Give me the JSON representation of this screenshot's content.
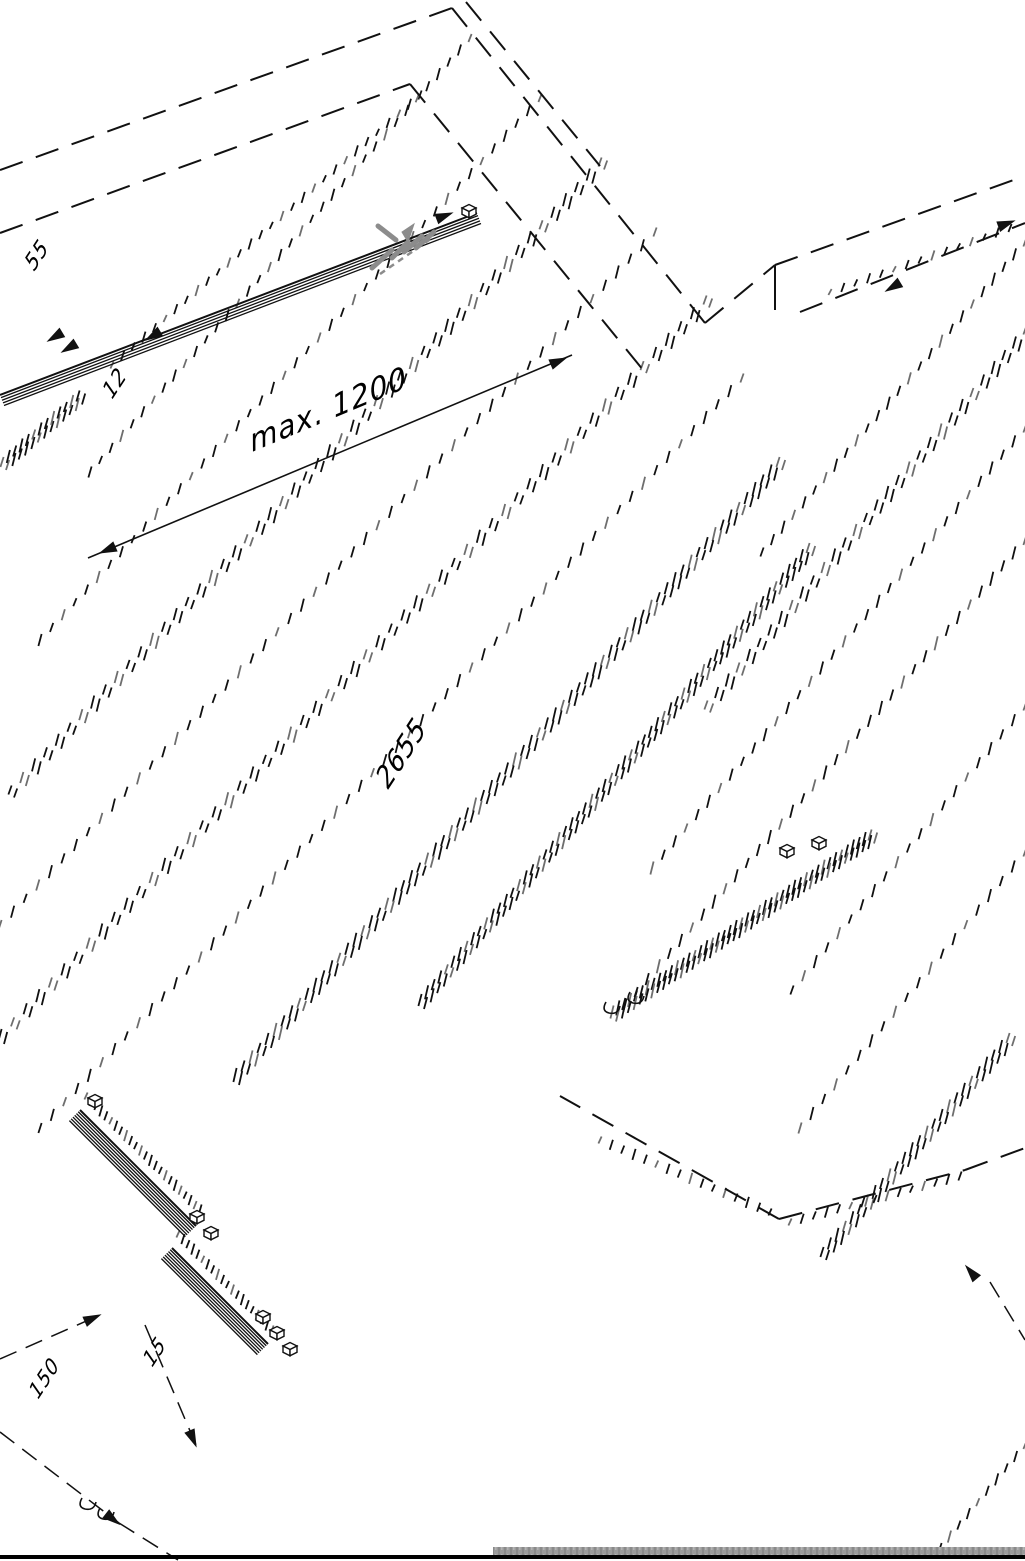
{
  "colors": {
    "ink": "#111111",
    "tick_gray": "#6e6e6e",
    "symbol_gray": "#8c8c8c",
    "floor_strip": "#9b9b9b",
    "floor_strip_dark": "#7f7f7f",
    "ground_line": "#000000",
    "background": "#ffffff"
  },
  "labels": {
    "track_width": "55",
    "panel_gap": "12",
    "max_spacing": "max. 1200",
    "panel_height": "2655",
    "floor_offset": "150",
    "floor_gap": "15"
  }
}
